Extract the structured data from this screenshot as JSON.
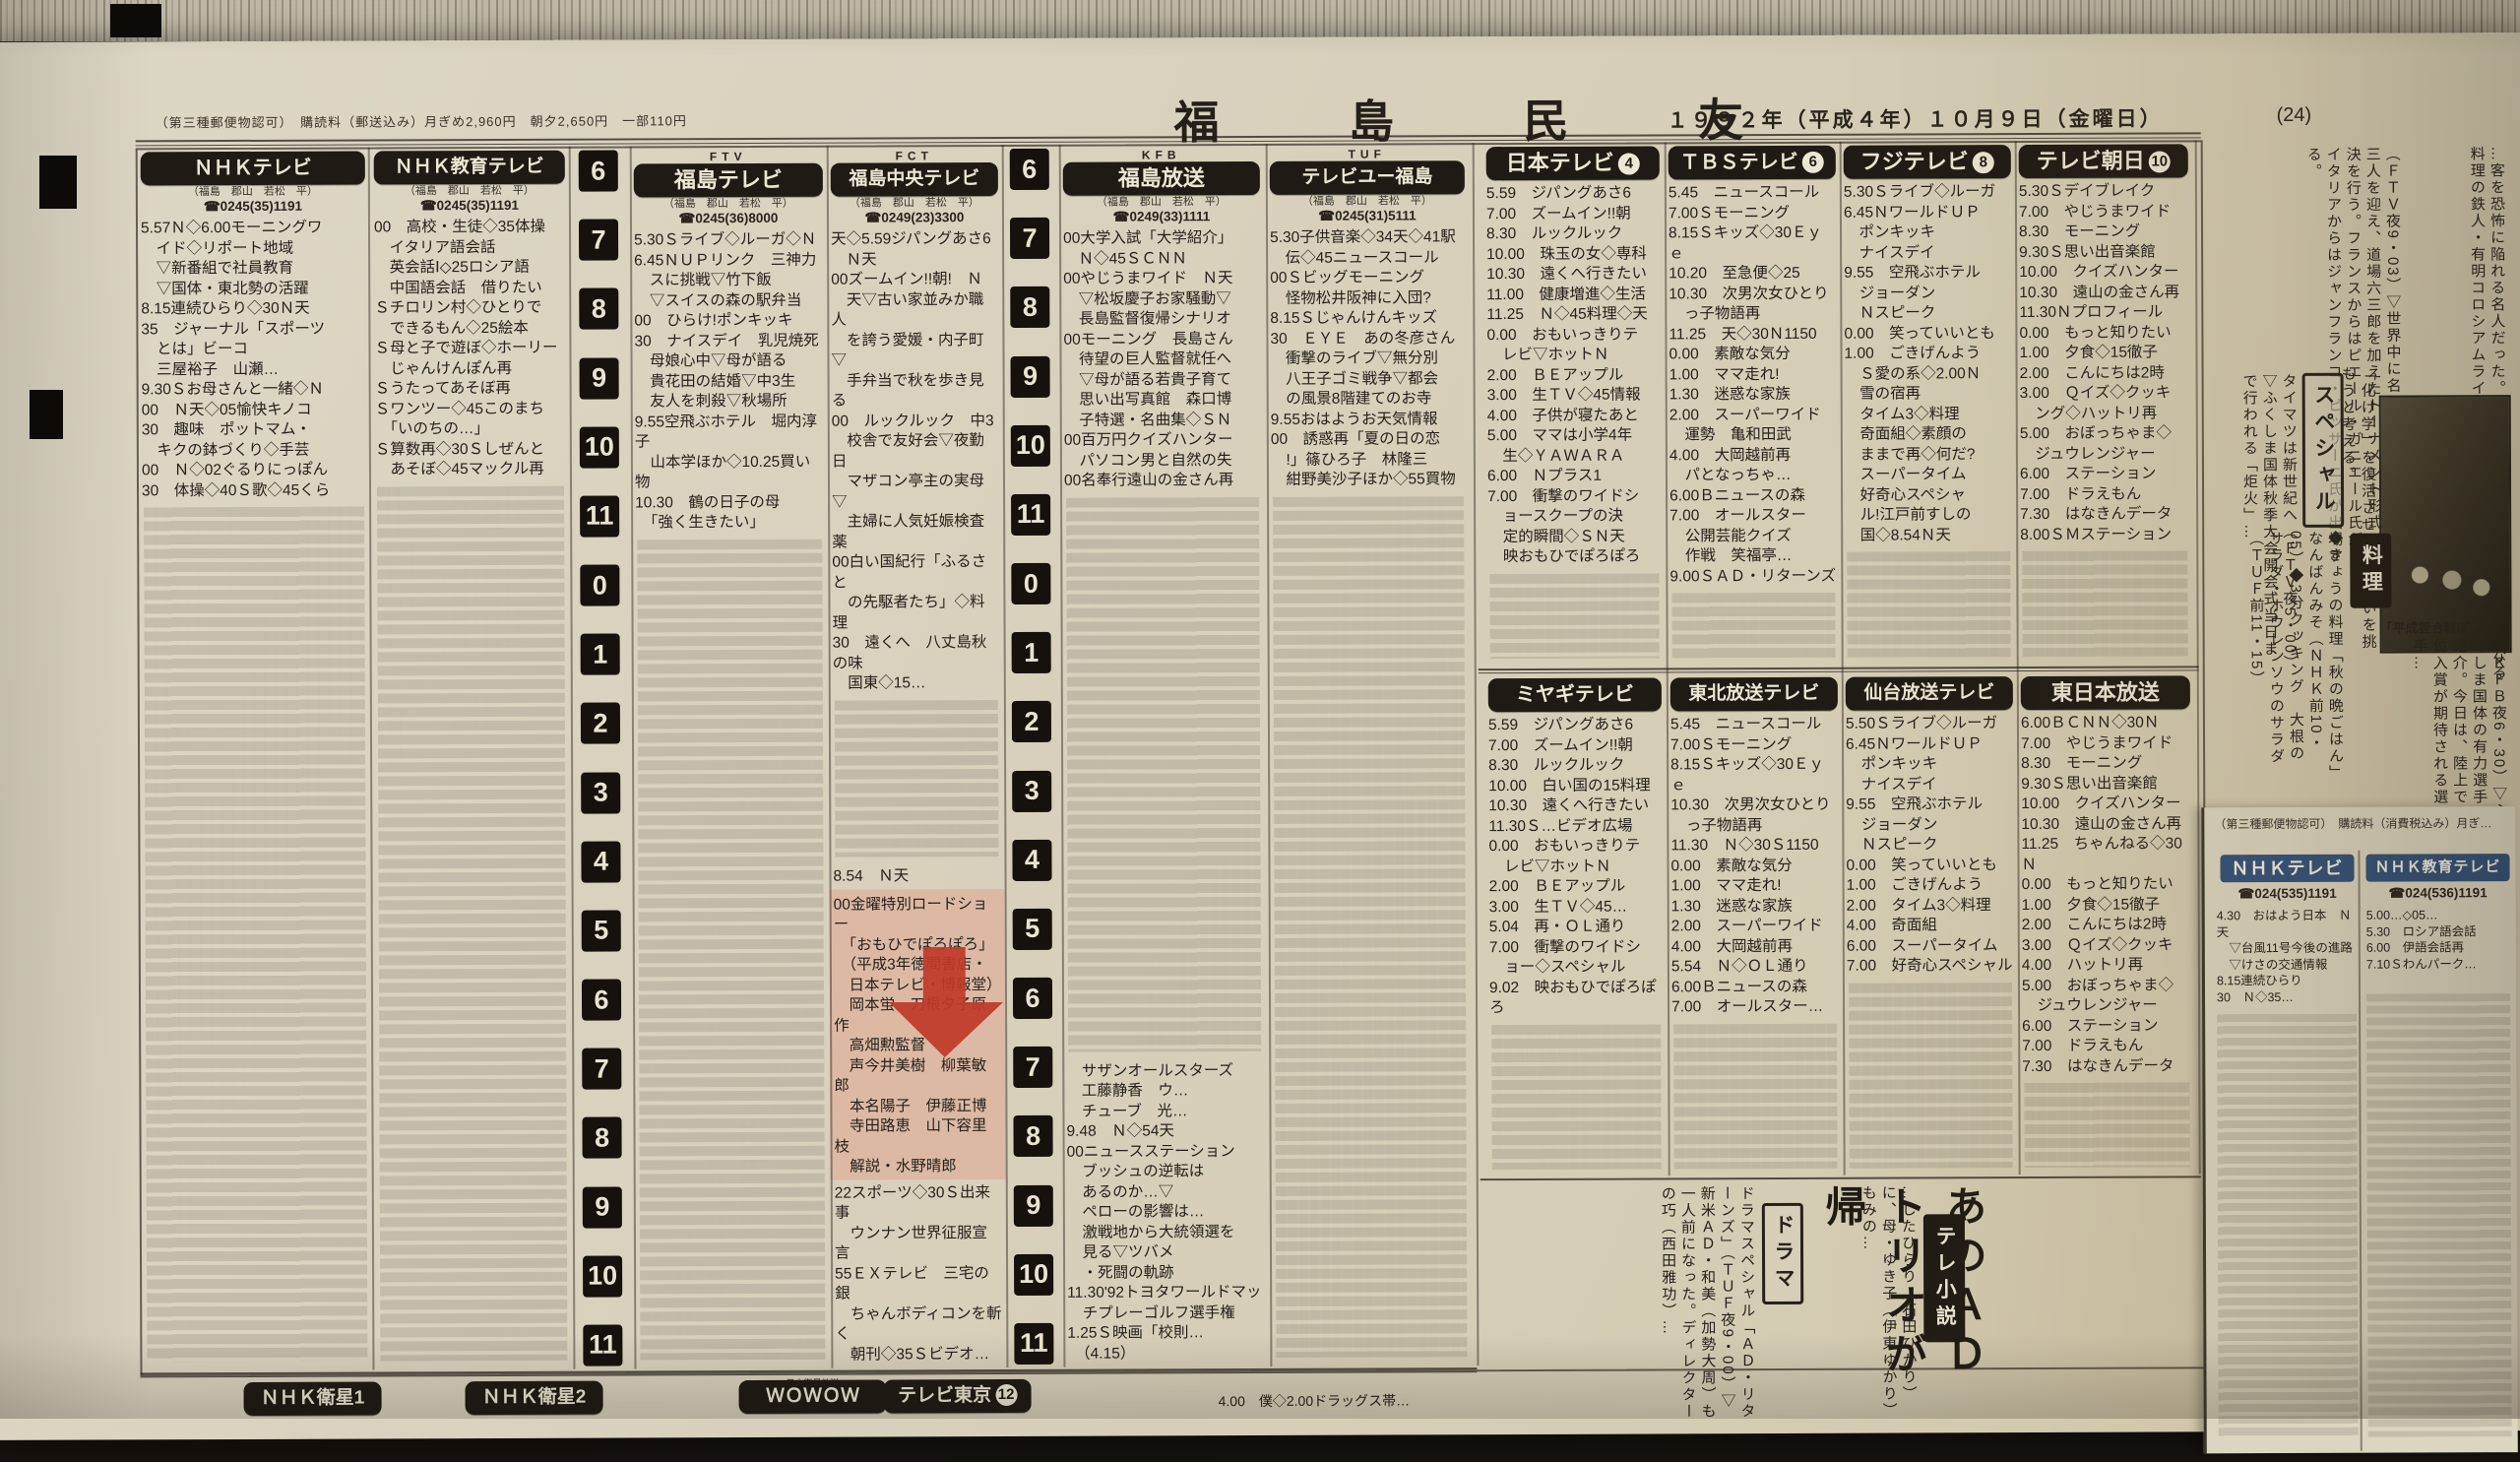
{
  "colors": {
    "paper": "#d8d1bd",
    "ink": "#26211b",
    "header_bg": "#1f1a14",
    "mini_header_bg": "#33517a",
    "arrow_red": "#bf3a28",
    "highlight_pink": "#e5927d"
  },
  "masthead": {
    "left_note": "（第三種郵便物認可）　購読料（郵送込み）月ぎめ2,960円　朝夕2,650円　一部110円",
    "title": "福 島 民 友",
    "date": "１９９２年（平成４年）１０月９日（金曜日）",
    "page_no": "(24)"
  },
  "time_ruler": [
    "6",
    "7",
    "8",
    "9",
    "10",
    "11",
    "0",
    "1",
    "2",
    "3",
    "4",
    "5",
    "6",
    "7",
    "8",
    "9",
    "10",
    "11"
  ],
  "channels": [
    {
      "label": "ＮＨＫテレビ",
      "logo": "",
      "sub": "（福島　郡山　若松　平）",
      "phone": "☎0245(35)1191",
      "lines": [
        "5.57Ｎ◇6.00モーニングワ",
        "　イド◇リポート地域",
        "　▽新番組で社員教育",
        "　▽国体・東北勢の活躍",
        "8.15連続ひらり◇30Ｎ天",
        "35　ジャーナル「スポーツ",
        "　とは」ビーコ",
        "　三屋裕子　山瀬…",
        "9.30Ｓお母さんと一緒◇Ｎ",
        "00　Ｎ天◇05愉快キノコ",
        "30　趣味　ポットマム・",
        "　キクの鉢づくり◇手芸",
        "00　Ｎ◇02ぐるりにっぽん",
        "30　体操◇40Ｓ歌◇45くら"
      ]
    },
    {
      "label": "ＮＨＫ教育テレビ",
      "logo": "",
      "sub": "（福島　郡山　若松　平）",
      "phone": "☎0245(35)1191",
      "lines": [
        "00　高校・生徒◇35体操",
        "　イタリア語会話",
        "　英会話Ⅰ◇25ロシア語",
        "　中国語会話　借りたい",
        "Ｓチロリン村◇ひとりで",
        "　できるもん◇25絵本",
        "Ｓ母と子で遊ぼ◇ホーリー",
        "　じゃんけんぽん再",
        "Ｓうたってあそぼ再",
        "Ｓワンツー◇45このまち",
        "　「いのちの…」",
        "Ｓ算数再◇30Ｓしぜんと",
        "　あそぼ◇45マックル再"
      ]
    },
    {
      "label": "福島テレビ",
      "logo": "FTV",
      "sub": "（福島　郡山　若松　平）",
      "phone": "☎0245(36)8000",
      "lines": [
        "5.30Ｓライブ◇ルーガ◇Ｎ",
        "6.45ＮＵＰリンク　三神力",
        "　スに挑戦▽竹下飯",
        "　▽スイスの森の駅弁当",
        "00　ひらけ!ポンキッキ",
        "30　ナイスデイ　乳児焼死",
        "　母娘心中▽母が語る",
        "　貴花田の結婚▽中3生",
        "　友人を刺殺▽秋場所",
        "9.55空飛ぶホテル　堀内淳子",
        "　山本学ほか◇10.25買い物",
        "10.30　鶴の日子の母",
        "　「強く生きたい」"
      ]
    },
    {
      "label": "福島中央テレビ",
      "logo": "FCT",
      "sub": "（福島　郡山　若松　平）",
      "phone": "☎0249(23)3300",
      "lines": [
        "天◇5.59ジパングあさ6",
        "　Ｎ天",
        "00ズームイン!!朝!　Ｎ",
        "　天▽古い家並みか職人",
        "　を誇う愛媛・内子町▽",
        "　手弁当で秋を歩き見る",
        "00　ルックルック　中3",
        "　校舎で友好会▽夜勤日",
        "　マザコン亭主の実母▽",
        "　主婦に人気妊娠検査薬",
        "00白い国紀行「ふるさと",
        "　の先駆者たち」◇料理",
        "30　遠くへ　八丈島秋の味",
        "　国東◇15…"
      ],
      "pre_line": "8.54　Ｎ天",
      "highlight_lines": [
        "00金曜特別ロードショー",
        "　「おもひでぽろぽろ」",
        "　（平成3年徳間書店・",
        "　日本テレビ・博報堂）",
        "　岡本蛍　刀根夕子原作",
        "　高畑勲監督",
        "　声今井美樹　柳葉敏郎",
        "　本名陽子　伊藤正博",
        "　寺田路恵　山下容里枝",
        "　解説・水野晴郎"
      ],
      "after_lines": [
        "22スポーツ◇30Ｓ出来事",
        "　ウンナン世界征服宣言",
        "55ＥＸテレビ　三宅の銀",
        "　ちゃんボディコンを斬く",
        "　朝刊◇35Ｓビデオ…"
      ]
    },
    {
      "label": "福島放送",
      "logo": "KFB",
      "sub": "（福島　郡山　若松　平）",
      "phone": "☎0249(33)1111",
      "lines": [
        "00大学入試「大学紹介」",
        "　Ｎ◇45ＳＣＮＮ",
        "00やじうまワイド　Ｎ天",
        "　▽松坂慶子お家騒動▽",
        "　長島監督復帰シナリオ",
        "00モーニング　長島さん",
        "　待望の巨人監督就任へ",
        "　▽母が語る若貴子育て",
        "　思い出写真館　森口博",
        "　子特選・名曲集◇ＳＮ",
        "00百万円クイズハンター",
        "　パソコン男と自然の失",
        "00名奉行遠山の金さん再"
      ],
      "evening_lines": [
        "　サザンオールスターズ",
        "　工藤静香　ウ…",
        "　チューブ　光…",
        "9.48　Ｎ◇54天",
        "00ニュースステーション",
        "　ブッシュの逆転は",
        "　あるのか…▽",
        "　ペローの影響は…",
        "　激戦地から大統領選を",
        "　見る▽ツバメ",
        "　・死闘の軌跡",
        "11.30'92トヨタワールドマッ",
        "　チプレーゴルフ選手権",
        "1.25Ｓ映画「校則…",
        "　（4.15）"
      ]
    },
    {
      "label": "テレビユー福島",
      "logo": "TUF",
      "sub": "（福島　郡山　若松　平）",
      "phone": "☎0245(31)5111",
      "lines": [
        "5.30子供音楽◇34天◇41駅",
        "　伝◇45ニュースコール",
        "00Ｓビッグモーニング",
        "　怪物松井阪神に入団?",
        "8.15Ｓじゃんけんキッズ",
        "30　ＥＹＥ　あの冬彦さん",
        "　衝撃のライブ▽無分別",
        "　八王子ゴミ戦争▽都会",
        "　の風景8階建てのお寺",
        "9.55おはようお天気情報",
        "00　誘惑再「夏の日の恋",
        "　!」篠ひろ子　林隆三",
        "　紺野美沙子ほか◇55買物"
      ]
    }
  ],
  "network": [
    {
      "label": "日本テレビ",
      "num": "4",
      "lines": [
        "5.59　ジパングあさ6",
        "7.00　ズームイン!!朝",
        "8.30　ルックルック",
        "10.00　珠玉の女◇専科",
        "10.30　遠くへ行きたい",
        "11.00　健康増進◇生活",
        "11.25　Ｎ◇45料理◇天",
        "0.00　おもいっきりテ",
        "　レビ▽ホットＮ",
        "2.00　ＢＥアップル",
        "3.00　生ＴＶ◇45情報",
        "4.00　子供が寝たあと",
        "5.00　ママは小学4年",
        "　生◇ＹＡＷＡＲＡ",
        "6.00　Ｎプラス1",
        "7.00　衝撃のワイドシ",
        "　ョースクープの決",
        "　定的瞬間◇ＳＮ天",
        "　映おもひでぽろぽろ"
      ]
    },
    {
      "label": "ＴＢＳテレビ",
      "num": "6",
      "lines": [
        "5.45　ニュースコール",
        "7.00Ｓモーニング",
        "8.15Ｓキッズ◇30Ｅｙｅ",
        "10.20　至急便◇25",
        "10.30　次男次女ひとり",
        "　っ子物語再",
        "11.25　天◇30Ｎ1150",
        "0.00　素敵な気分",
        "1.00　ママ走れ!",
        "1.30　迷惑な家族",
        "2.00　スーパーワイド",
        "　運勢　亀和田武",
        "4.00　大岡越前再",
        "　パとなっちゃ…",
        "6.00Ｂニュースの森",
        "7.00　オールスター",
        "　公開芸能クイズ",
        "　作戦　笑福亭…",
        "9.00ＳＡＤ・リターンズ"
      ]
    },
    {
      "label": "フジテレビ",
      "num": "8",
      "lines": [
        "5.30Ｓライブ◇ルーガ",
        "6.45ＮワールドＵＰ",
        "　ポンキッキ",
        "　ナイスデイ",
        "9.55　空飛ぶホテル",
        "　ジョーダン",
        "　Ｎスピーク",
        "0.00　笑っていいとも",
        "1.00　ごきげんよう",
        "　Ｓ愛の系◇2.00Ｎ",
        "　雪の宿再",
        "　タイム3◇料理",
        "　奇面組◇素顔の",
        "　ままで再◇何だ?",
        "　スーパータイム",
        "　好奇心スペシャ",
        "　ル!江戸前すしの",
        "　国◇8.54Ｎ天"
      ]
    },
    {
      "label": "テレビ朝日",
      "num": "10",
      "lines": [
        "5.30Ｓデイブレイク",
        "7.00　やじうまワイド",
        "8.30　モーニング",
        "9.30Ｓ思い出音楽館",
        "10.00　クイズハンター",
        "10.30　遠山の金さん再",
        "11.30Ｎプロフィール",
        "0.00　もっと知りたい",
        "1.00　夕食◇15徹子",
        "2.00　こんにちは2時",
        "3.00　Ｑイズ◇クッキ",
        "　ング◇ハットリ再",
        "5.00　おぼっちゃま◇",
        "　ジュウレンジャー",
        "6.00　ステーション",
        "7.00　ドラえもん",
        "7.30　はなきんデータ",
        "8.00ＳＭステーション"
      ]
    }
  ],
  "sendai": [
    {
      "label": "ミヤギテレビ",
      "lines": [
        "5.59　ジパングあさ6",
        "7.00　ズームイン!!朝",
        "8.30　ルックルック",
        "10.00　白い国の15料理",
        "10.30　遠くへ行きたい",
        "11.30Ｓ…ビデオ広場",
        "0.00　おもいっきりテ",
        "　レビ▽ホットＮ",
        "2.00　ＢＥアップル",
        "3.00　生ＴＶ◇45…",
        "5.04　再・ＯＬ通り",
        "7.00　衝撃のワイドシ",
        "　ョー◇スペシャル",
        "9.02　映おもひでぽろぽろ"
      ]
    },
    {
      "label": "東北放送テレビ",
      "lines": [
        "5.45　ニュースコール",
        "7.00Ｓモーニング",
        "8.15Ｓキッズ◇30Ｅｙｅ",
        "10.30　次男次女ひとり",
        "　っ子物語再",
        "11.30　Ｎ◇30Ｓ1150",
        "0.00　素敵な気分",
        "1.00　ママ走れ!",
        "1.30　迷惑な家族",
        "2.00　スーパーワイド",
        "4.00　大岡越前再",
        "5.54　Ｎ◇ＯＬ通り",
        "6.00Ｂニュースの森",
        "7.00　オールスター…"
      ]
    },
    {
      "label": "仙台放送テレビ",
      "lines": [
        "5.50Ｓライブ◇ルーガ",
        "6.45ＮワールドＵＰ",
        "　ポンキッキ",
        "　ナイスデイ",
        "9.55　空飛ぶホテル",
        "　ジョーダン",
        "　Ｎスピーク",
        "0.00　笑っていいとも",
        "1.00　ごきげんよう",
        "2.00　タイム3◇料理",
        "4.00　奇面組",
        "6.00　スーパータイム",
        "7.00　好奇心スペシャル"
      ]
    },
    {
      "label": "東日本放送",
      "lines": [
        "6.00ＢＣＮＮ◇30Ｎ",
        "7.00　やじうまワイド",
        "8.30　モーニング",
        "9.30Ｓ思い出音楽館",
        "10.00　クイズハンター",
        "10.30　遠山の金さん再",
        "11.25　ちゃんねる◇30Ｎ",
        "0.00　もっと知りたい",
        "1.00　夕食◇15徹子",
        "2.00　こんにちは2時",
        "3.00　Ｑイズ◇クッキ",
        "4.00　ハットリ再",
        "5.00　おぼっちゃま◇",
        "　ジュウレンジャー",
        "6.00　ステーション",
        "7.00　ドラえもん",
        "7.30　はなきんデータ"
      ]
    }
  ],
  "satellite": {
    "items": [
      {
        "label": "ＮＨＫ衛星1",
        "num": ""
      },
      {
        "label": "ＮＨＫ衛星2",
        "num": ""
      },
      {
        "label": "ＷＯＷＯＷ",
        "num": "",
        "note": "日本衛星放送"
      },
      {
        "label": "テレビ東京",
        "num": "12",
        "note": ""
      }
    ],
    "teleto_line": "4.00　僕◇2.00ドラッグス帯…"
  },
  "features": {
    "top_fragment": "…客を恐怖に陥れる名人だった。ほか、調理室の風景化など、完全なる料理の鉄人・有明コロシアムライフ",
    "top_main": "（ＦＴＶ夜9・03）▽世界中に名の知れたトップシェフ三人を迎え、道場六三郎を加えたトーナメント形式の対決を行う。フランスからはピエール・ガニエール氏が、イタリアからはジャンフランコ・ビッサーニ氏が出場する。",
    "special_label": "スペシャル",
    "special_text": "タイマツは新世紀へ（ＦＴＶ夜5・00）▽ふくしま国体秋季大会開会式当日まで行われる「炬火」…",
    "ghibli_note": "「化け学」を復活させ人間に戦いを挑もうと考える。",
    "photo_caption": "「平成狸合戦ぽ…",
    "kfb_fragment": "（ＫＦＢ夜6・30）▽ふくしま国体の有力選手を紹介。今日は、陸上で上位入賞が期待される選手…",
    "cooking_label": "料理",
    "cooking_text": "◆きょうの料理「秋の晩ごはん」なんばんみそ（ＮＨＫ前10・05）◆3分クッキング　大根のサラダ・ホウレンソウのサラダ（ＴＵＦ前11・15）",
    "ad_headline": "あのＡＤトリオが帰",
    "drama_label": "ドラマ",
    "drama_text": "ドラマスペシャル「ＡＤ・リターンズ」（ＴＵＦ夜9・00）▽新米ＡＤ・和美（加勢大周）も一人前になった。ディレクターの巧（西田雅功）…",
    "tv_novel_label": "テレ小説",
    "tv_novel_text": "…したひらり（石田ひかり）に、母・ゆき子（伊東ゆかり）もみの…",
    "annotation_points_to": "金曜特別ロードショー「おもひでぽろぽろ」"
  },
  "mini": {
    "note": "（第三種郵便物認可）　購読料（消費税込み）月ぎ…",
    "channels": [
      {
        "label": "ＮＨＫテレビ",
        "phone": "☎024(535)1191",
        "lines": [
          "4.30　おはよう日本　Ｎ天",
          "　▽台風11号今後の進路",
          "　▽けさの交通情報",
          "8.15連続ひらり",
          "30　Ｎ◇35…"
        ]
      },
      {
        "label": "ＮＨＫ教育テレビ",
        "phone": "☎024(536)1191",
        "lines": [
          "5.00…◇05…",
          "5.30　ロシア語会話",
          "6.00　伊語会話再",
          "7.10Ｓわんパーク…"
        ]
      }
    ]
  }
}
